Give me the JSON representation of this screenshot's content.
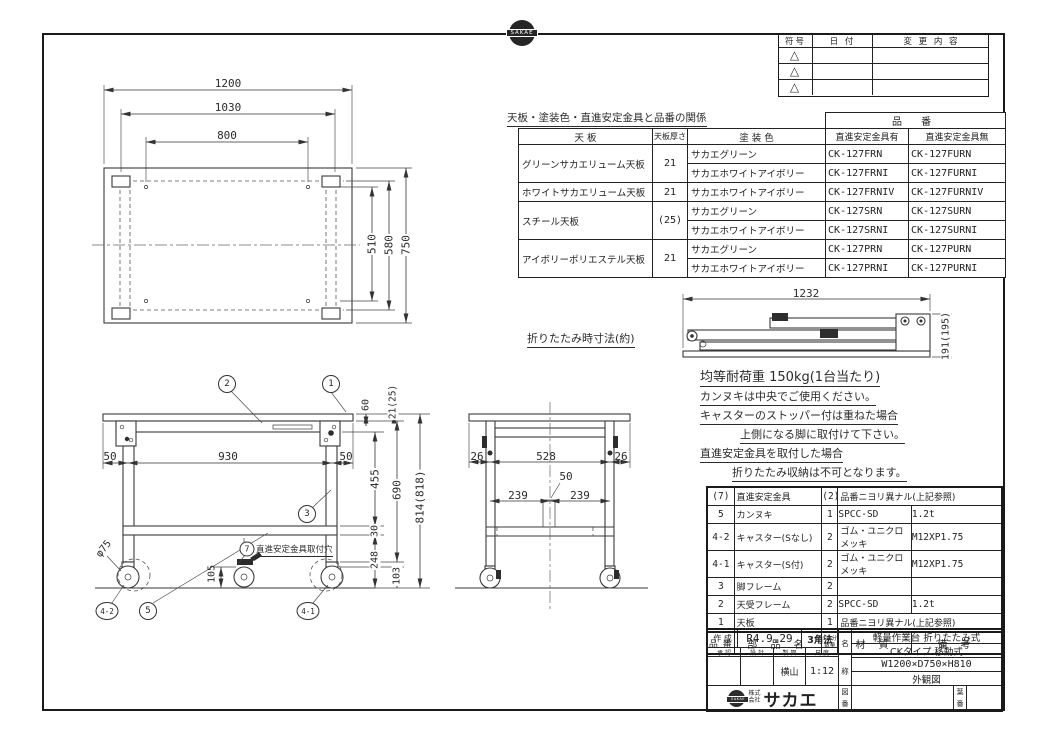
{
  "logo": {
    "stamp_text": "SAKAE"
  },
  "revision_table": {
    "col_symbol": "符号",
    "col_date": "日 付",
    "col_change": "変 更 内 容",
    "symbol_mark": "△"
  },
  "spec_table": {
    "title": "天板・塗装色・直進安定金具と品番の関係",
    "part_number_header": "品 番",
    "col_top": "天 板",
    "col_thickness": "天板厚さ",
    "col_color": "塗 装 色",
    "col_with": "直進安定金具有",
    "col_without": "直進安定金具無",
    "groups": [
      {
        "top": "グリーンサカエリューム天板",
        "thickness": "21"
      },
      {
        "top": "ホワイトサカエリューム天板",
        "thickness": "21"
      },
      {
        "top": "スチール天板",
        "thickness": "(25)"
      },
      {
        "top": "アイボリーポリエステル天板",
        "thickness": "21"
      }
    ],
    "rows": [
      {
        "color": "サカエグリーン",
        "with_part": "CK-127FRN",
        "without_part": "CK-127FURN"
      },
      {
        "color": "サカエホワイトアイボリー",
        "with_part": "CK-127FRNI",
        "without_part": "CK-127FURNI"
      },
      {
        "color": "サカエホワイトアイボリー",
        "with_part": "CK-127FRNIV",
        "without_part": "CK-127FURNIV"
      },
      {
        "color": "サカエグリーン",
        "with_part": "CK-127SRN",
        "without_part": "CK-127SURN"
      },
      {
        "color": "サカエホワイトアイボリー",
        "with_part": "CK-127SRNI",
        "without_part": "CK-127SURNI"
      },
      {
        "color": "サカエグリーン",
        "with_part": "CK-127PRN",
        "without_part": "CK-127PURN"
      },
      {
        "color": "サカエホワイトアイボリー",
        "with_part": "CK-127PRNI",
        "without_part": "CK-127PURNI"
      }
    ]
  },
  "folded_view": {
    "label": "折りたたみ時寸法(約)",
    "width": "1232",
    "height": "191(195)"
  },
  "notes": {
    "load": "均等耐荷重 150kg(1台当たり)",
    "line1": "カンヌキは中央でご使用ください。",
    "line2": "キャスターのストッパー付は重ねた場合",
    "line3": "上側になる脚に取付けて下さい。",
    "line4": "直進安定金具を取付した場合",
    "line5": "折りたたみ収納は不可となります。"
  },
  "dimensions": {
    "plan": {
      "overall_width": "1200",
      "leg_span": "1030",
      "hole_span": "800",
      "hole_depth": "510",
      "leg_depth": "580",
      "overall_depth": "750"
    },
    "front": {
      "left_offset": "50",
      "caster_span": "930",
      "right_offset": "50",
      "top_frame": "60",
      "top_thickness": "21(25)",
      "leg_clear": "455",
      "under_top": "690",
      "rail": "30",
      "lower": "248",
      "caster_h": "103",
      "total_height": "814(818)",
      "caster_dia": "φ75",
      "stabilizer_h": "105"
    },
    "side": {
      "left_offset": "26",
      "leg_span": "528",
      "right_offset": "26",
      "center_width": "50",
      "left_half": "239",
      "right_half": "239"
    }
  },
  "balloons": {
    "b1": "1",
    "b2": "2",
    "b3": "3",
    "b4_1": "4-1",
    "b4_2": "4-2",
    "b5": "5",
    "b7": "7",
    "b7_label": "直進安定金具取付穴"
  },
  "parts_table": {
    "col_no": "品 番",
    "col_name": "部 品 名",
    "col_qty": "1台分数量",
    "col_material": "材 質",
    "col_remarks": "備 考",
    "rows": [
      {
        "no": "(7)",
        "name": "直進安定金具",
        "qty": "(2)",
        "material": "品番ニヨリ異ナル(上記参照)",
        "remarks": ""
      },
      {
        "no": "5",
        "name": "カンヌキ",
        "qty": "1",
        "material": "SPCC-SD",
        "remarks": "1.2t"
      },
      {
        "no": "4-2",
        "name": "キャスター(Sなし)",
        "qty": "2",
        "material": "ゴム・ユニクロメッキ",
        "remarks": "M12XP1.75"
      },
      {
        "no": "4-1",
        "name": "キャスター(S付)",
        "qty": "2",
        "material": "ゴム・ユニクロメッキ",
        "remarks": "M12XP1.75"
      },
      {
        "no": "3",
        "name": "脚フレーム",
        "qty": "2",
        "material": "",
        "remarks": ""
      },
      {
        "no": "2",
        "name": "天受フレーム",
        "qty": "2",
        "material": "SPCC-SD",
        "remarks": "1.2t"
      },
      {
        "no": "1",
        "name": "天板",
        "qty": "1",
        "material": "品番ニヨリ異ナル(上記参照)",
        "remarks": ""
      }
    ]
  },
  "title_block": {
    "created_label": "作 成",
    "created_value": "R4.9.29",
    "projection": "3角法",
    "h_approve": "承 認",
    "h_design": "設 計",
    "h_draft": "製 図",
    "h_scale": "尺 度",
    "drafter": "横山",
    "scale": "1:12",
    "name_label_top": "名",
    "name_label_bottom": "称",
    "name_line1": "軽量作業台 折りたたみ式",
    "name_line2": "CKタイプ 移動式",
    "name_line3": "W1200×D750×H810",
    "name_line4": "外観図",
    "drawing_no_top": "図",
    "drawing_no_bottom": "番",
    "sheet_no_top": "葉",
    "sheet_no_bottom": "番",
    "company_prefix_1": "株式",
    "company_prefix_2": "会社",
    "company_name": "サカエ"
  }
}
